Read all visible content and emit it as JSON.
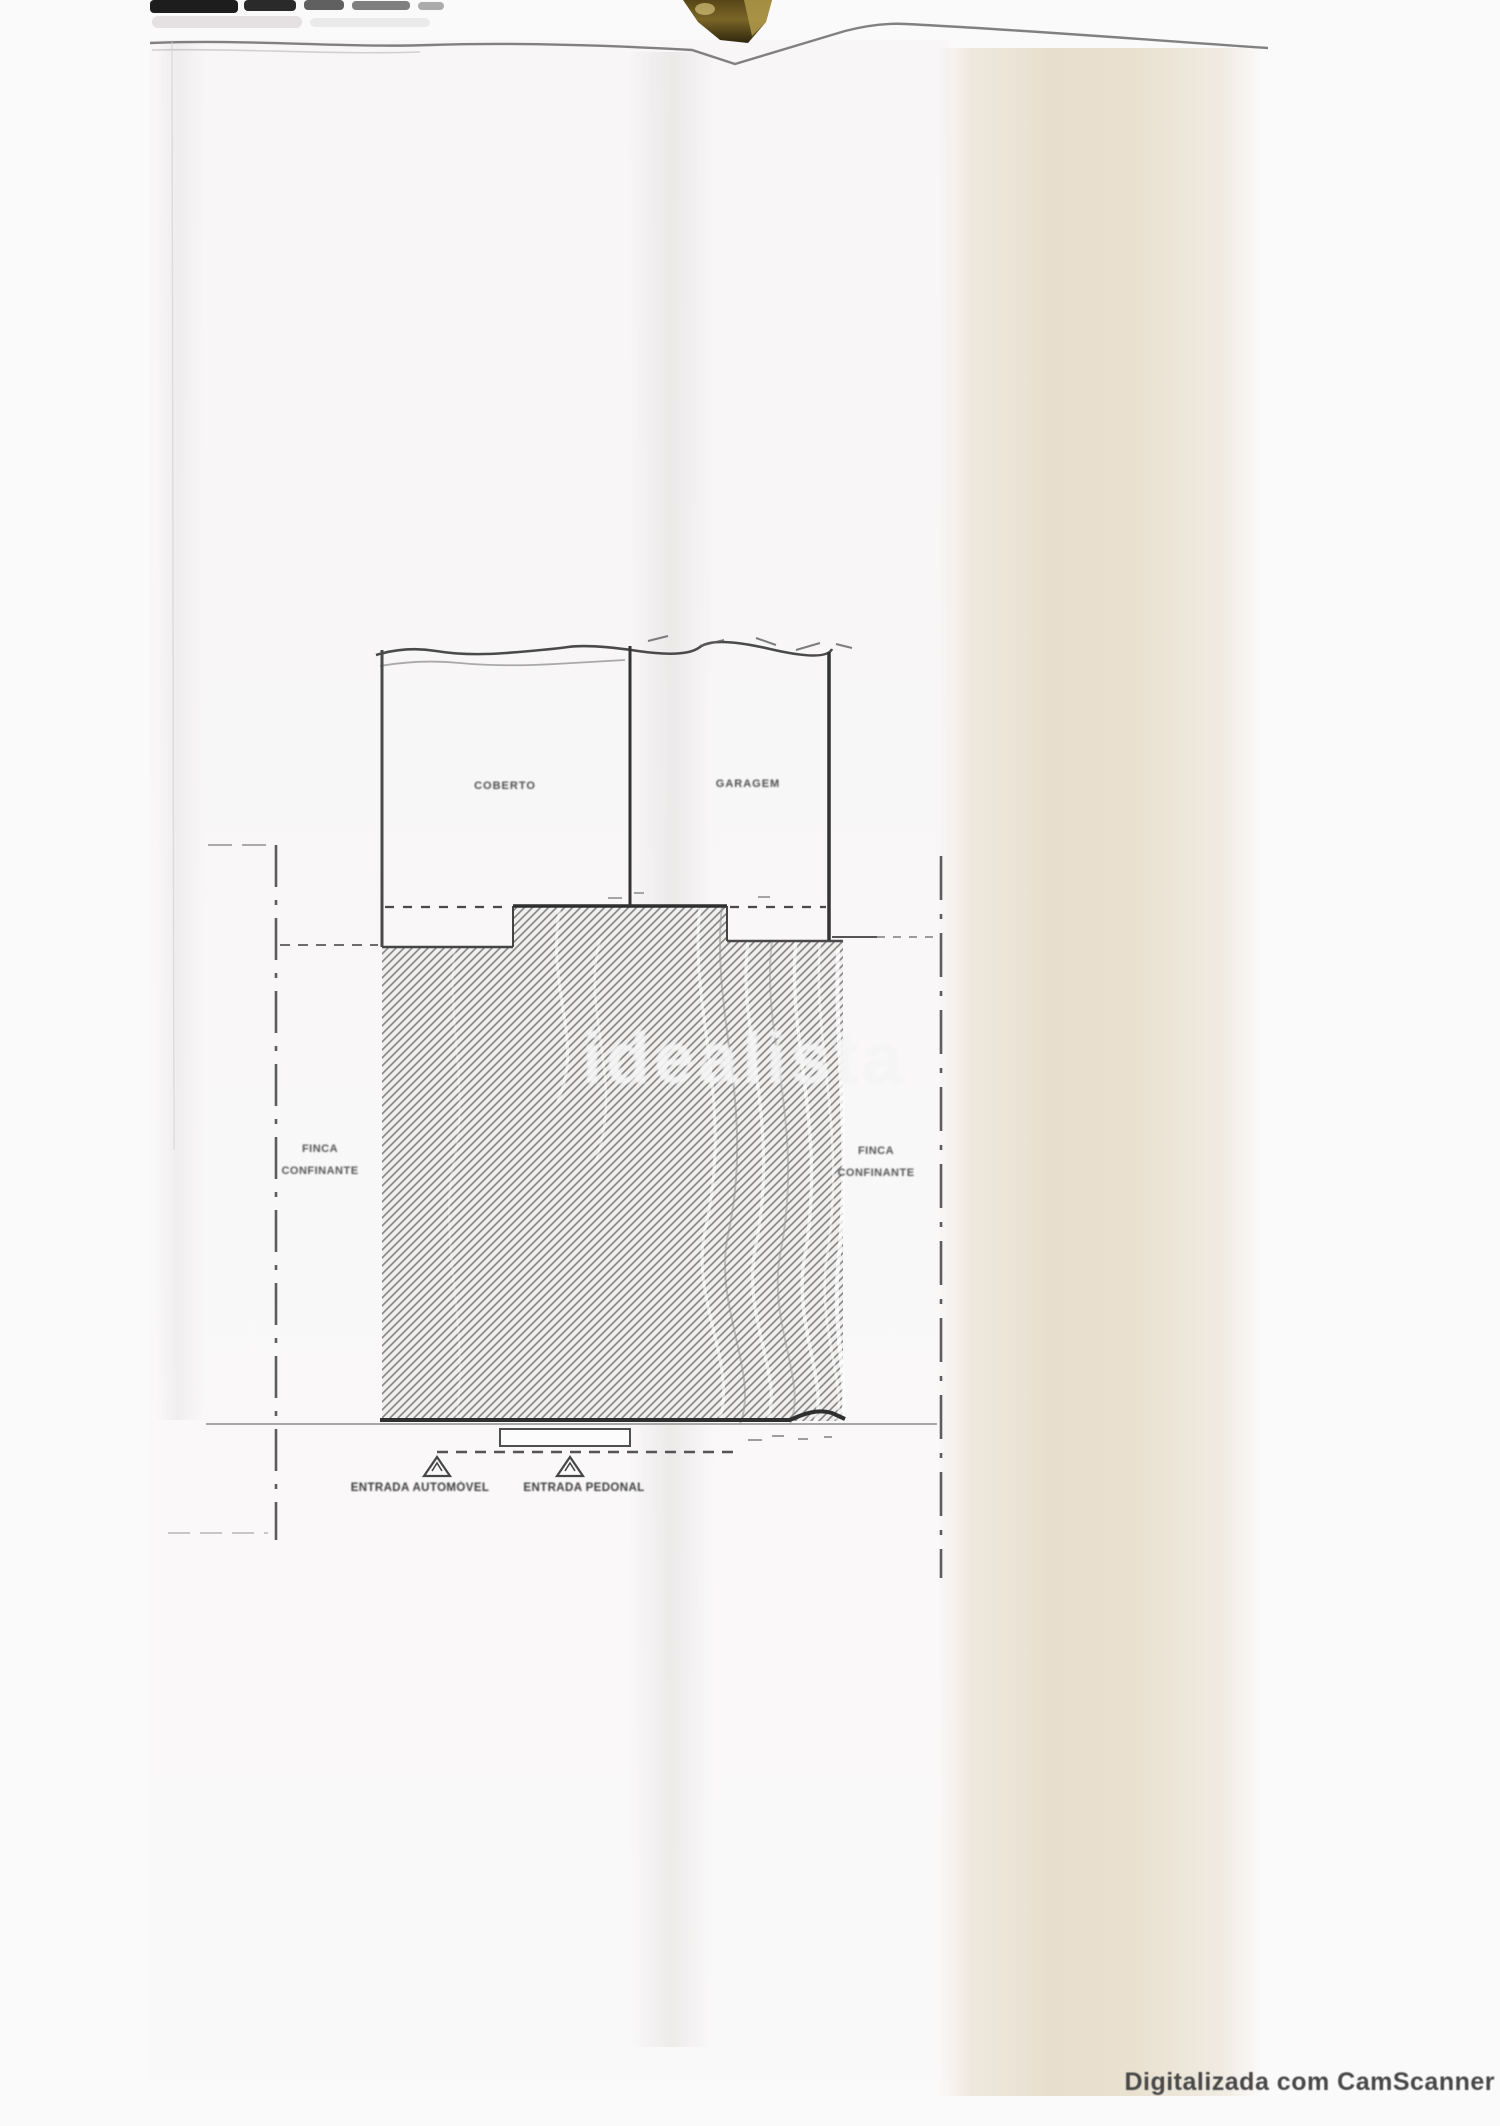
{
  "document": {
    "watermark": "idealista",
    "scanner_note": "Digitalizada com CamScanner"
  },
  "plan": {
    "rooms": [
      {
        "label": "COBERTO"
      },
      {
        "label": "GARAGEM"
      }
    ],
    "boundary_labels": {
      "left_line1": "FINCA",
      "left_line2": "CONFINANTE",
      "right_line1": "FINCA",
      "right_line2": "CONFINANTE"
    },
    "entrances": [
      {
        "label": "ENTRADA AUTOMÓVEL",
        "marker": "triangle-icon"
      },
      {
        "label": "ENTRADA PEDONAL",
        "marker": "triangle-icon"
      }
    ]
  },
  "colors": {
    "paper": "#fbfafa",
    "fold_beige": "#e9e0cf",
    "ink_dark": "#333333",
    "ink_mid": "#555555",
    "hatch_stroke": "#858585",
    "clip_gold": "#7a6526",
    "watermark_white": "#f4f4f4"
  }
}
